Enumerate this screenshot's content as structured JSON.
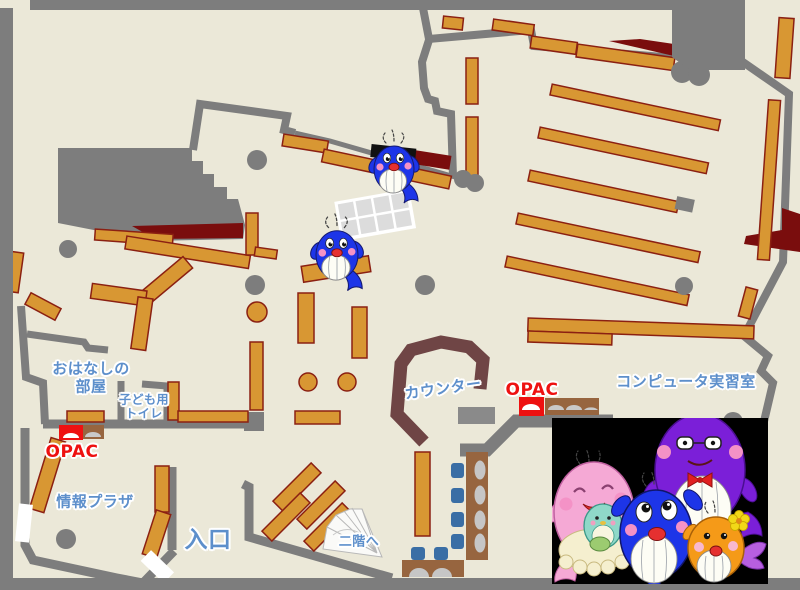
{
  "labels": {
    "storytelling_room": {
      "line1": "おはなしの",
      "line2": "部屋"
    },
    "kids_toilet": {
      "line1": "子ども用",
      "line2": "トイレ"
    },
    "opac_left": "OPAC",
    "info_plaza": "情報プラザ",
    "entrance": "入口",
    "to_second_floor": "二階へ",
    "counter": "カウンター",
    "opac_center": "OPAC",
    "computer_room": "コンピュータ実習室"
  },
  "colors": {
    "floor": "#EBE8D8",
    "wall_gray": "#7D7D7D",
    "shelf_tan": "#D89733",
    "shelf_border": "#8B2012",
    "dark_red": "#7A0D0D",
    "counter_brown": "#6F4545",
    "table_brown": "#97653F",
    "chair_blue": "#3A6EA5",
    "seat_gray": "#C6C6C6",
    "label_blue": "#5D8FCB",
    "label_red": "#EE1111",
    "photo_bg": "#000000",
    "whale_blue": "#1D35E8",
    "whale_pink": "#F5A9D5",
    "whale_purple": "#7B1FD8",
    "whale_orange": "#F59A18"
  }
}
